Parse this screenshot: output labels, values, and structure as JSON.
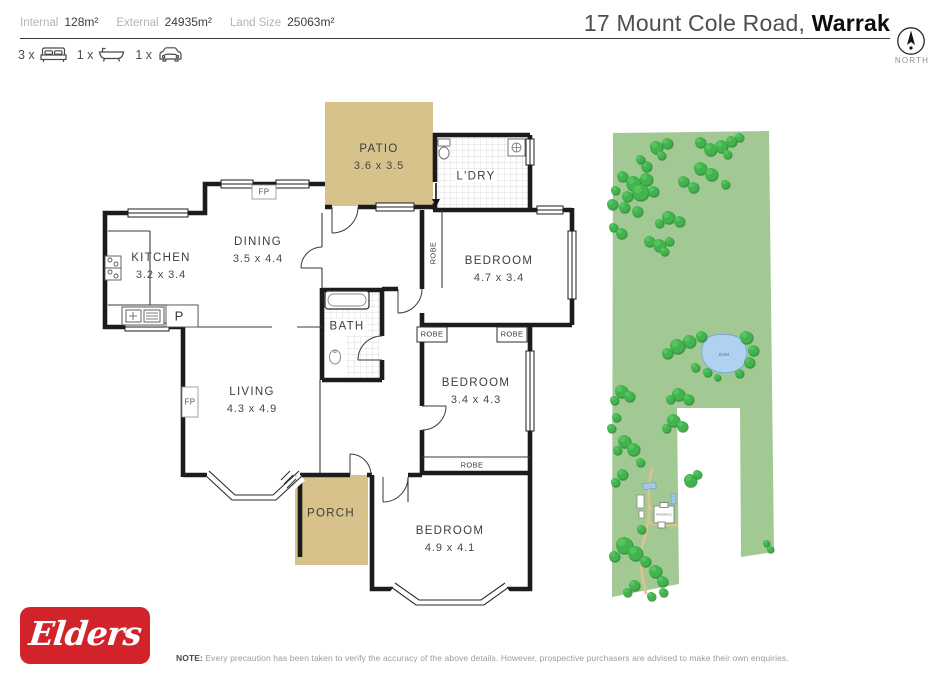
{
  "header": {
    "stats": [
      {
        "label": "Internal",
        "value": "128m²"
      },
      {
        "label": "External",
        "value": "24935m²"
      },
      {
        "label": "Land Size",
        "value": "25063m²"
      }
    ],
    "title_prefix": "17 Mount Cole Road, ",
    "title_suburb": "Warrak",
    "features": [
      {
        "count": "3 x",
        "icon": "bed-icon"
      },
      {
        "count": "1 x",
        "icon": "bath-icon"
      },
      {
        "count": "1 x",
        "icon": "car-icon"
      }
    ],
    "compass_label": "NORTH"
  },
  "floorplan": {
    "rooms": {
      "patio": {
        "name": "PATIO",
        "dims": "3.6 x 3.5"
      },
      "laundry": {
        "name": "L'DRY"
      },
      "kitchen": {
        "name": "KITCHEN",
        "dims": "3.2 x 3.4"
      },
      "dining": {
        "name": "DINING",
        "dims": "3.5 x 4.4"
      },
      "bedroom1": {
        "name": "BEDROOM",
        "dims": "4.7 x 3.4"
      },
      "bath": {
        "name": "BATH"
      },
      "living": {
        "name": "LIVING",
        "dims": "4.3 x 4.9"
      },
      "bedroom2": {
        "name": "BEDROOM",
        "dims": "3.4 x 4.3"
      },
      "bedroom3": {
        "name": "BEDROOM",
        "dims": "4.9 x 4.1"
      },
      "porch": {
        "name": "PORCH"
      }
    },
    "markers": {
      "robe": "ROBE",
      "fireplace": "FP",
      "pantry": "P"
    }
  },
  "land": {
    "dam_label": "DAM",
    "residence_label": "RESIDENCE"
  },
  "footer": {
    "brand": "Elders",
    "note_label": "NOTE:",
    "note_text": " Every precaution has been taken to verify the accuracy of the above details. However, prospective purchasers are advised to make their own enquiries."
  },
  "colors": {
    "accent_red": "#d2232a",
    "patio_tan": "#d7c28b",
    "land_green": "#a2c993",
    "tree_green": "#41b44d",
    "dam_blue": "#aed2ef",
    "wall_black": "#1c1c1c"
  }
}
